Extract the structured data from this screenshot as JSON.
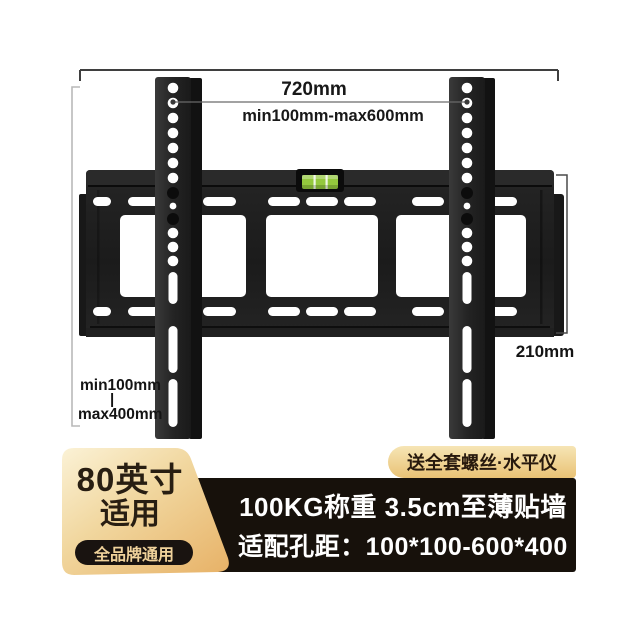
{
  "annotations": {
    "top_width": "720mm",
    "hole_width_range": "min100mm-max600mm",
    "hole_height_min": "min100mm",
    "hole_height_divider": "|",
    "hole_height_max": "max400mm",
    "plate_height": "210mm"
  },
  "size_badge": {
    "line1": "80英寸",
    "line2": "适用",
    "sub_pill": "全品牌通用",
    "bg_top": "#fbf2d6",
    "bg_bottom": "#e7b166",
    "text_color": "#281e12"
  },
  "gift_pill": {
    "text": "送全套螺丝·水平仪",
    "bg_top": "#f6e5b5",
    "bg_bottom": "#e9c275",
    "text_color": "#27190d"
  },
  "info_bar": {
    "line1": "100KG称重 3.5cm至薄贴墙",
    "line2": "适配孔距：100*100-600*400",
    "bg": "#17110b",
    "text_color": "#ffffff"
  },
  "product": {
    "bracket_color": "#1c1c1c",
    "level_color": "#94c83d"
  }
}
